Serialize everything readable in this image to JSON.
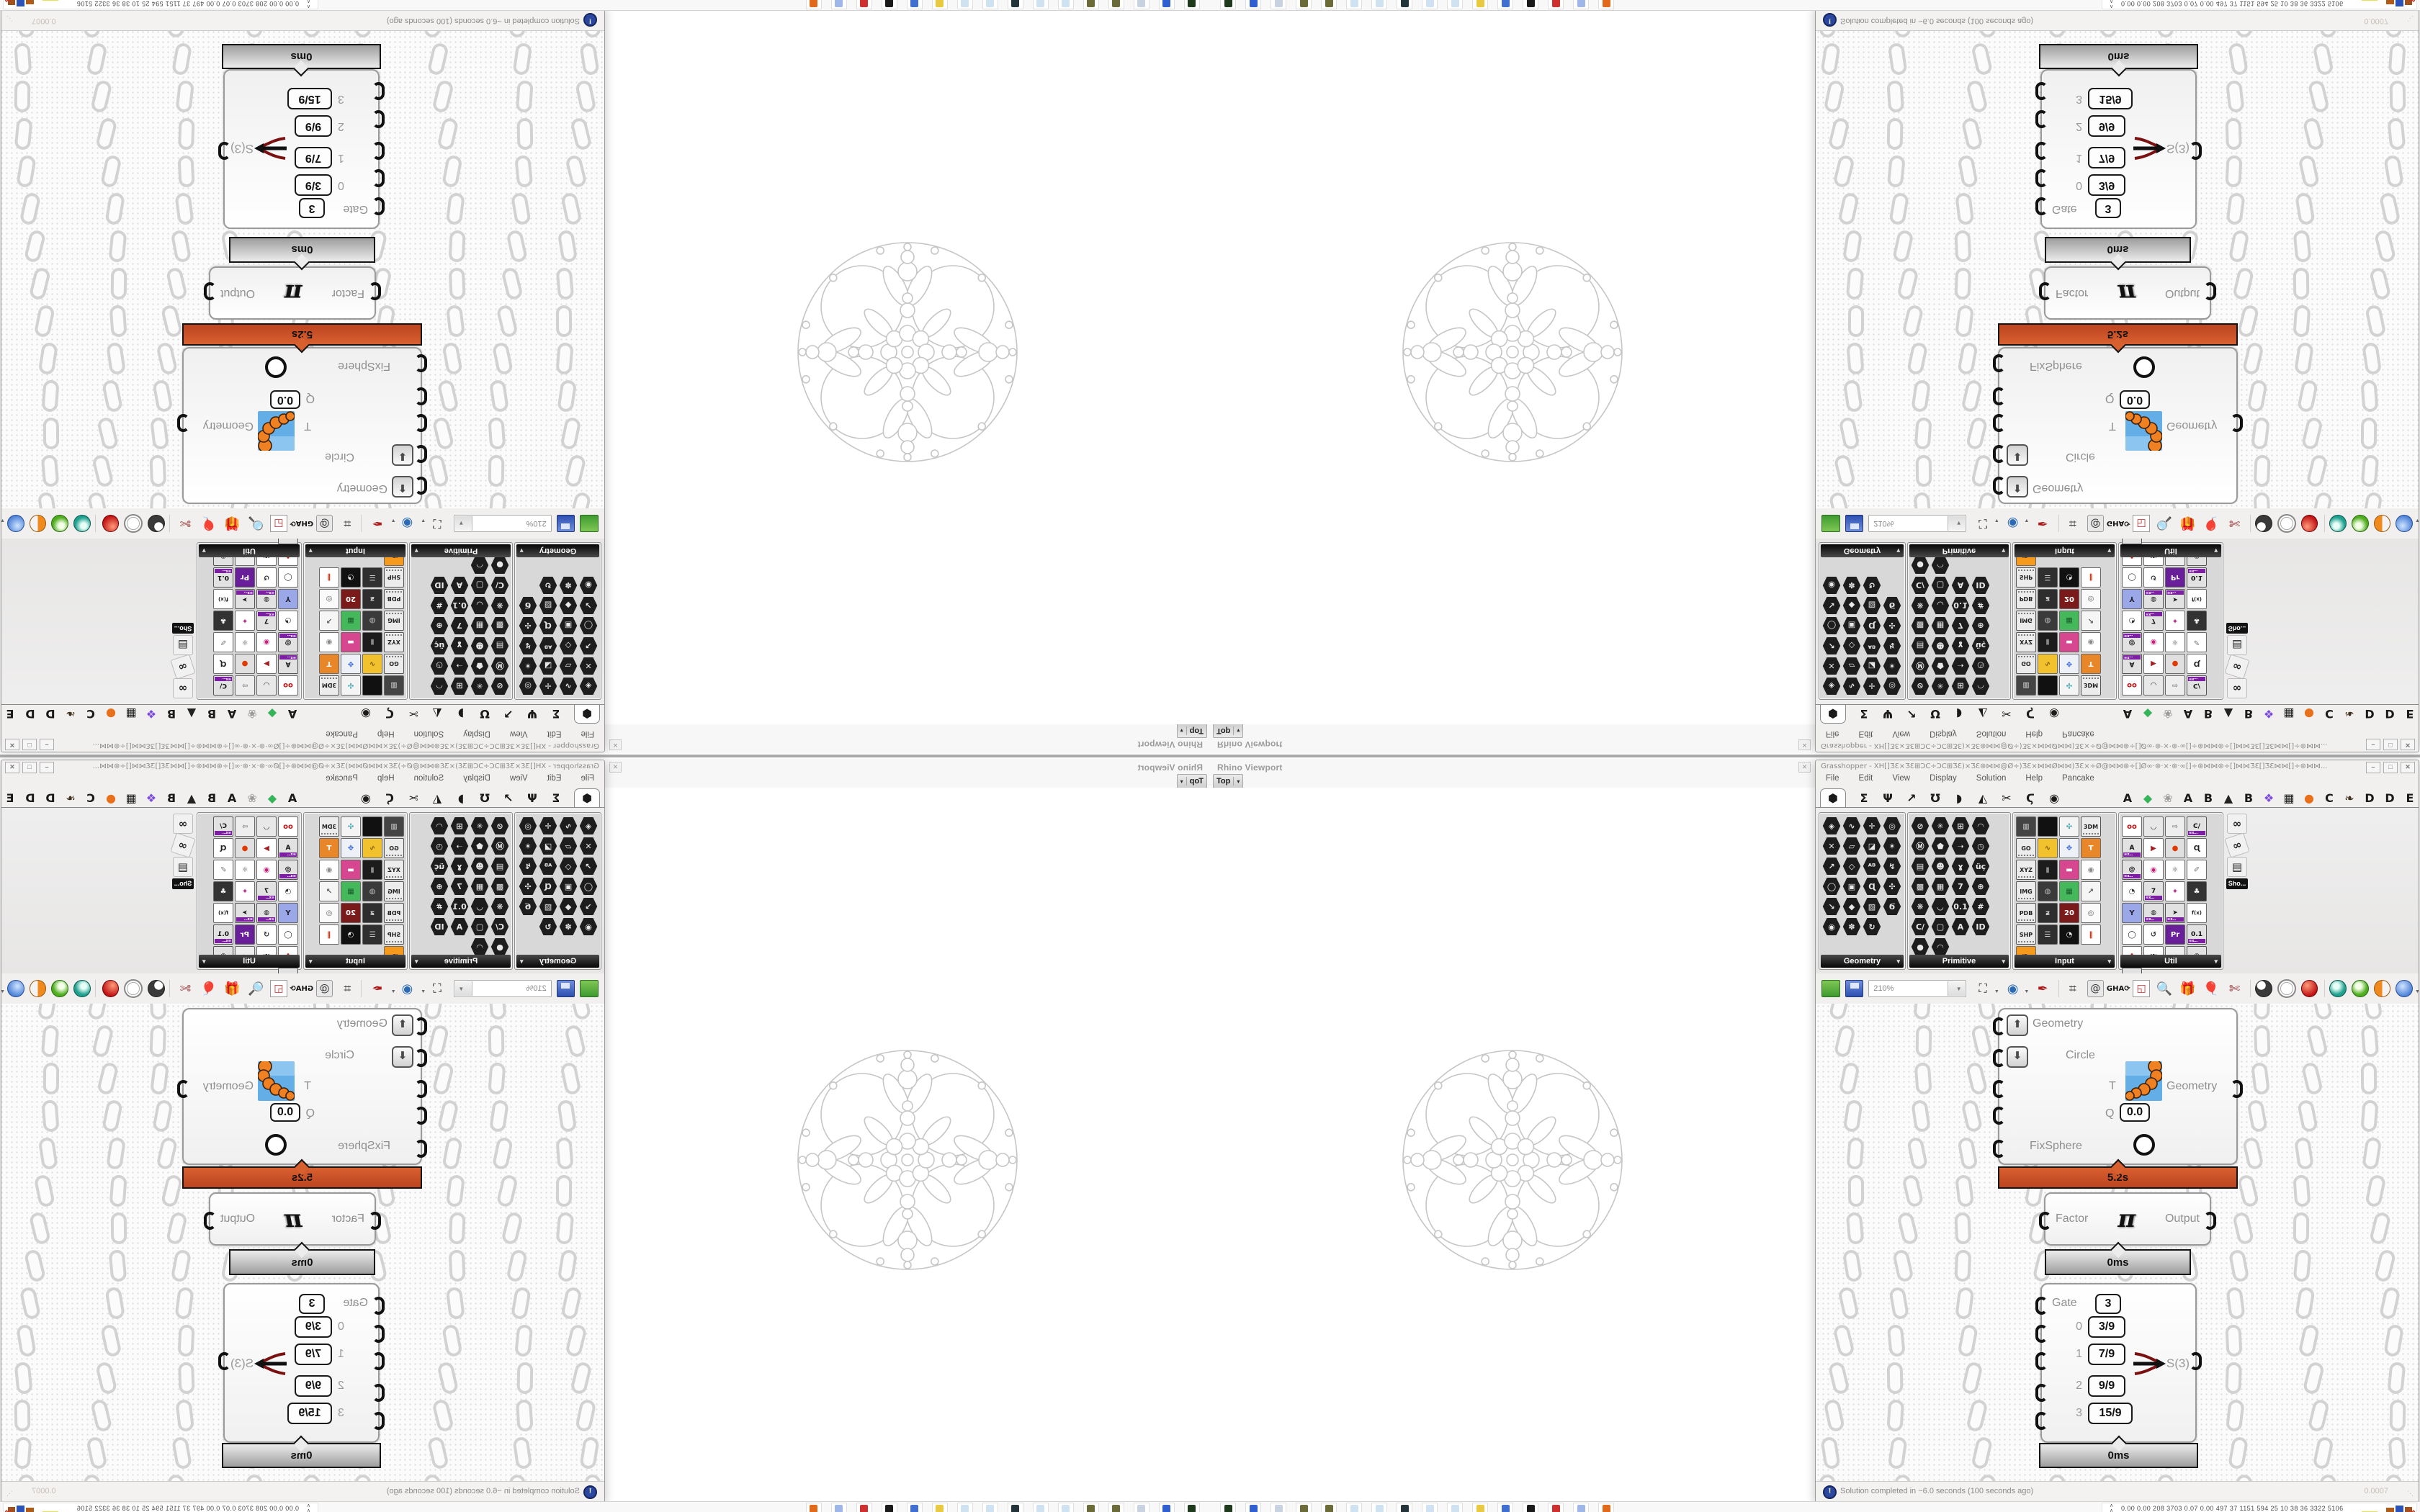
{
  "viewport": {
    "title": "Rhino Viewport",
    "view_button": "Top",
    "close_glyph": "✕"
  },
  "window": {
    "title": "Grasshopper - XH[]ƷƐ×ƷƐ⊞ƆC÷ƆC⊞ƷƐ)×ƷƐ⊛⋈⋈@Ø÷)ƷƐ×⋈⋈Ø⋈⋈)ƷƐ×÷Ø@⋈⋈⊛÷[]Ø∞·⊛·×·⊛·∞[]÷⊛⋈⋈⊛÷[]⋈⋈ƷƐ[]ƷƐ⋈⋈[]÷⊛⋈⋈...",
    "buttons": [
      "–",
      "□",
      "✕"
    ]
  },
  "menu": {
    "items": [
      "File",
      "Edit",
      "View",
      "Display",
      "Solution",
      "Help",
      "Pancake"
    ]
  },
  "tabs": {
    "icon_tabs": [
      {
        "g": "⬢",
        "sel": true
      },
      {
        "g": "Σ"
      },
      {
        "g": "Ψ"
      },
      {
        "g": "↗"
      },
      {
        "g": "Ʊ"
      },
      {
        "g": "◗"
      },
      {
        "g": "◭"
      },
      {
        "g": "✂"
      },
      {
        "g": "Ϛ"
      },
      {
        "g": "◉"
      }
    ],
    "plugin_tabs": [
      {
        "g": "A"
      },
      {
        "g": "◆",
        "c": "#35b559"
      },
      {
        "g": "❀",
        "c": "#9a9a9a"
      },
      {
        "g": "A"
      },
      {
        "g": "B"
      },
      {
        "g": "▲",
        "c": "#222222"
      },
      {
        "g": "B"
      },
      {
        "g": "❖",
        "c": "#7a4ae0"
      },
      {
        "g": "▦"
      },
      {
        "g": "●",
        "c": "#e8701a"
      },
      {
        "g": "C"
      },
      {
        "g": "❧",
        "c": "#42301e"
      },
      {
        "g": "D"
      },
      {
        "g": "D"
      },
      {
        "g": "E"
      },
      {
        "g": "E"
      },
      {
        "g": "▩"
      },
      {
        "g": "E"
      }
    ]
  },
  "panels": [
    {
      "name": "Geometry",
      "cols": 4,
      "icons": [
        "H|◈",
        "H|∿",
        "H|✛",
        "H|◎",
        "H|✕",
        "H|▱",
        "H|◪",
        "H|✶",
        "H|↗",
        "H|◇",
        "H|ᴬᴮ",
        "H|↯",
        "H|◯",
        "H|▣",
        "H|Ɋ",
        "H|✣",
        "H|↘",
        "H|◆",
        "H|▨",
        "H|Ϭ",
        "H|◉",
        "H|✽",
        "H|↻"
      ]
    },
    {
      "name": "Primitive",
      "cols": 5,
      "icons": [
        "H|⊘",
        "H|✳",
        "H|⊞",
        "H|◠",
        "H|Ⓜ",
        "H|⬟",
        "H|➝",
        "H|◷",
        "H|▤",
        "H|☻",
        "H|ɣ",
        "H|üç",
        "H|▩",
        "H|▦",
        "H|7",
        "H|⊕",
        "H|❋",
        "H|◡",
        "H|0.1",
        "H|#",
        "H|C/",
        "H|▢",
        "H|A",
        "H|ID",
        "H|●",
        "H|◠"
      ]
    },
    {
      "name": "Input",
      "cols": 5,
      "icons": [
        "S|#444444|▥|#dddddd",
        "S|#111111||#111111",
        "S|#f4f4f4|✣|#2a99aa",
        "C|3DM",
        "C|GO",
        "S|#f2c12e|∿|#7a5a00",
        "S|#eef2f8|✥|#3a6ad4",
        "S|#e8862a|T|#ffffff",
        "C|XYZ",
        "S|#1c1c1c|▮|#888888",
        "S|#d6478f|▬|#ffffff",
        "S|#ffffff|◉|#888888",
        "C|IMG",
        "S|#3a3a3a|◍|#bbbbbb",
        "S|#46b85c|▦|#1a5a2a",
        "S|#f5f5f5|↗|#555555",
        "C|PDB",
        "S|#2e2e2e|ƶ|#cccccc",
        "S|#7a1a1a|20|#ffffff",
        "S|#fafafa|◎|#666666",
        "C|SHP",
        "S|#2f2f2f|☰|#cccccc",
        "S|#111111|◔|#eeeeee",
        "S|#ffffff|‖|#cc2200",
        "S|#f59a1c|ID.|#7a3a00"
      ]
    },
    {
      "name": "Util",
      "cols": 5,
      "icons": [
        "S|#ffffff|oo|#c01414",
        "S|#e8e8e8|◡|#222222",
        "S|#eeeeee|⇨|#8a8a8a",
        "X|C/",
        "X|A",
        "S|#ffffff|▶|#a32121",
        "S|#e0e0e0|●|#e03a00",
        "S|#ffffff|Ɋ|#222222",
        "X|@",
        "S|#ffffff|◉|#c2257a",
        "S|#ffffff|⚛|#555555",
        "S|#ffffff|✐|#777777",
        "S|#ffffff|◔|#333333",
        "X|7",
        "S|#ffffff|✦|#b82a8a",
        "S|#333333|♣|#eeeeee",
        "S|#9aa8e8|Y|#222233",
        "X|◍",
        "X|➤",
        "S|#ffffff|f(x)|#222222",
        "S|#ffffff|◯|#222222",
        "S|#ffffff|↺|#333333",
        "S|#6a1f9a|Pr|#ffffff",
        "X|0.1",
        "S|#ffffff|❖|#cc2222",
        "S|#ffffff|ᴬᴮᶜ|#333333",
        "S|#eeeeee|⇨|#888888",
        "X|◉",
        "X|✖"
      ]
    }
  ],
  "shelf_more": {
    "label": "Sho...",
    "icons": [
      "∞",
      "∞",
      "▤"
    ]
  },
  "toolbar": {
    "zoom_value": "210%"
  },
  "canvas": {
    "fixsphere": {
      "inputs": [
        "Geometry",
        "Circle",
        "T",
        "Q",
        "FixSphere"
      ],
      "q_value": "0.0",
      "output": "Geometry",
      "time": "5.2s"
    },
    "pi": {
      "input": "Factor",
      "symbol": "π",
      "output": "Output",
      "time": "0ms"
    },
    "gate": {
      "label": "Gate",
      "gate_value": "3",
      "rows": [
        {
          "index": "0",
          "value": "3/9"
        },
        {
          "index": "1",
          "value": "7/9"
        },
        {
          "index": "2",
          "value": "9/9"
        },
        {
          "index": "3",
          "value": "15/9"
        }
      ],
      "output": "S(3)",
      "time": "0ms"
    }
  },
  "status": {
    "text": "Solution completed in ~6.0 seconds (100 seconds ago)",
    "right_value": "0.0007"
  },
  "taskbar": {
    "tray_text": "0.00 0.00  208 3703 0.07 0.00  497   37   1151 594   25    10    38    36  3322 5106",
    "app_icon_colors": [
      "#1d3a1d",
      "#2f5fd0",
      "#c9d2e0",
      "#6b6b38",
      "#6b6b38",
      "#cfe2f2",
      "#cfe2f2",
      "#22343a",
      "#cfe2f2",
      "#cfe2f2",
      "#e8c93f",
      "#3f6fd0",
      "#1a1a1a",
      "#d02f2f",
      "#9fb6e8",
      "#e06a1a"
    ]
  }
}
